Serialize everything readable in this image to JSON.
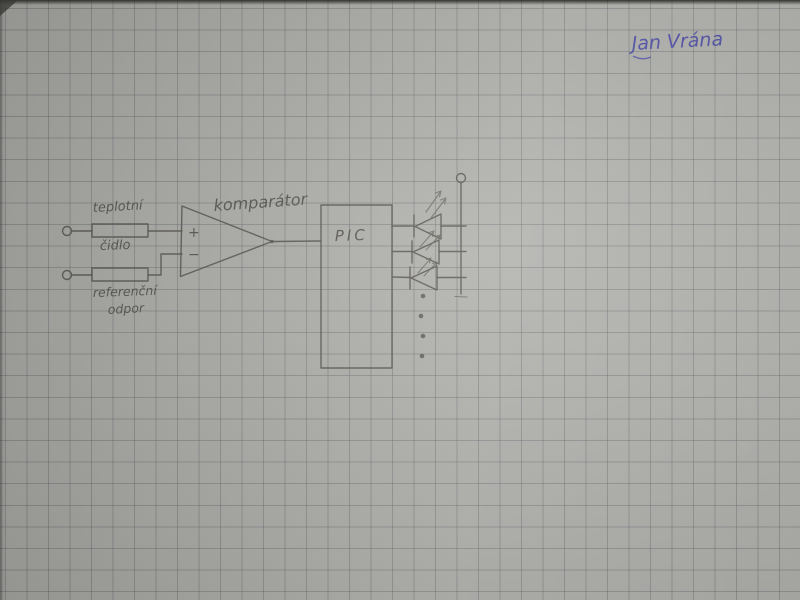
{
  "photo": {
    "paper_color": "#afafab",
    "grid_color": "#60646c",
    "pencil_color": "#55534d",
    "ink_color": "#4a4aa6"
  },
  "signature": {
    "text": "Jan Vrána"
  },
  "schematic": {
    "labels": {
      "temp1": "teplotní",
      "temp2": "čidlo",
      "ref1": "referenční",
      "ref2": "odpor",
      "comparator": "komparátor",
      "plus": "+",
      "minus": "−",
      "mcu": "PIC"
    },
    "leds": {
      "drawn_count": 3,
      "ellipsis_dot_count": 4
    },
    "terminals": {
      "input_count": 2,
      "output_count": 1
    }
  }
}
